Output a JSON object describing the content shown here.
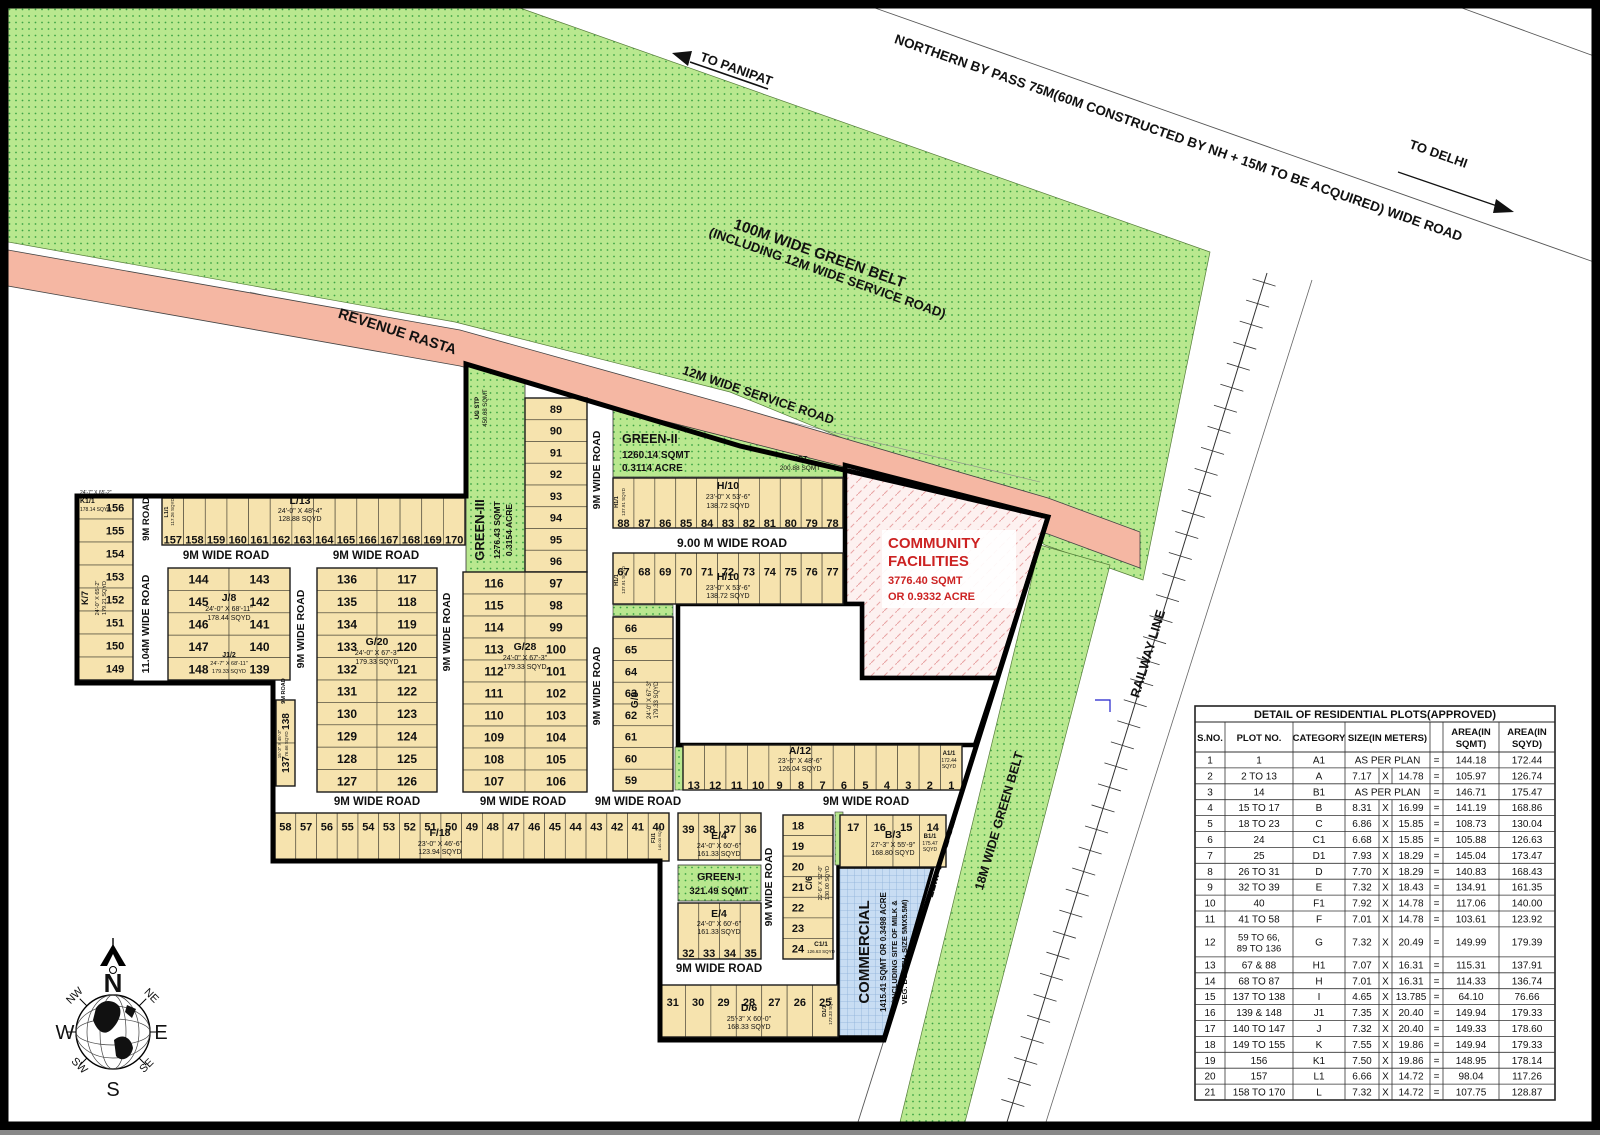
{
  "header": {
    "to_panipat": "TO PANIPAT",
    "to_delhi": "TO DELHI",
    "bypass_road": "NORTHERN BY PASS 75M(60M CONSTRUCTED BY NH + 15M TO BE ACQUIRED) WIDE ROAD",
    "green_belt_line1": "100M WIDE GREEN BELT",
    "green_belt_line2": "(INCLUDING 12M WIDE SERVICE ROAD)",
    "revenue_rasta": "REVENUE RASTA",
    "service_road_top": "12M WIDE SERVICE ROAD"
  },
  "right_side": {
    "service_road": "12M WIDE SERVICE ROAD",
    "green_belt": "18M WIDE GREEN BELT",
    "railway": "RAILWAY LINE"
  },
  "roads": {
    "nine_wide": "9M WIDE ROAD",
    "nine": "9M ROAD",
    "nine00": "9.00 M WIDE ROAD",
    "eleven": "11.04M WIDE ROAD"
  },
  "green_areas": {
    "green1": [
      "GREEN-I",
      "321.49 SQMT"
    ],
    "green2": [
      "GREEN-II",
      "1260.14 SQMT",
      "0.3114 ACRE"
    ],
    "green3": [
      "GREEN-III",
      "1276.43 SQMT",
      "0.3154 ACRE"
    ],
    "ug_stp": [
      "UG STP",
      "450.68 SQMT"
    ],
    "ugt": [
      "UGT",
      "200.88 SQMT"
    ]
  },
  "community": {
    "line1": "COMMUNITY",
    "line2": "FACILITIES",
    "area": "3776.40 SQMT",
    "acre": "OR 0.9332 ACRE"
  },
  "commercial": {
    "name": "COMMERCIAL",
    "line1": "1415.41 SQMT OR 0.3498 ACRE",
    "line2": "(INCLUDING SITE OF MILK &",
    "line3": "VEG. BOOTH- SIZE 5MX5.5M)"
  },
  "blocks": {
    "k": {
      "plots": [
        "156",
        "155",
        "154",
        "153",
        "152",
        "151",
        "150",
        "149"
      ],
      "label": {
        "name": "K/7",
        "dims": "24'-0\" X 65'-2\"",
        "area": "179.21 SQYD"
      }
    },
    "k1": {
      "name": "K1/1",
      "dims": "24'-7\" X 65'-2\"",
      "area": "178.14 SQYD"
    },
    "l": {
      "plots": [
        "157",
        "158",
        "159",
        "160",
        "161",
        "162",
        "163",
        "164",
        "165",
        "166",
        "167",
        "168",
        "169",
        "170"
      ],
      "label": {
        "name": "L/13",
        "dims": "24'-0\" X 48'-4\"",
        "area": "128.88 SQYD"
      }
    },
    "l1": {
      "name": "L1/1",
      "area": "117.26 SQYD"
    },
    "j": {
      "rows": [
        [
          "144",
          "143"
        ],
        [
          "145",
          "142"
        ],
        [
          "146",
          "141"
        ],
        [
          "147",
          "140"
        ],
        [
          "148",
          "139"
        ]
      ],
      "label": {
        "name": "J/8",
        "dims": "24'-0\" X 68'-11\"",
        "area": "178.44 SQYD"
      },
      "label2": {
        "name": "J1/2",
        "dims": "24'-7\" X 68'-11\"",
        "area": "179.33 SQYD"
      }
    },
    "i": {
      "plots": [
        "138",
        "137"
      ],
      "label": {
        "dims": "15'-3\" X 45'-3\"",
        "area": "76.66 SQYD"
      }
    },
    "g20": {
      "rows": [
        [
          "136",
          "117"
        ],
        [
          "135",
          "118"
        ],
        [
          "134",
          "119"
        ],
        [
          "133",
          "120"
        ],
        [
          "132",
          "121"
        ],
        [
          "131",
          "122"
        ],
        [
          "130",
          "123"
        ],
        [
          "129",
          "124"
        ],
        [
          "128",
          "125"
        ],
        [
          "127",
          "126"
        ]
      ],
      "label": {
        "name": "G/20",
        "dims": "24'-0\" X 67'-3\"",
        "area": "179.33 SQYD"
      }
    },
    "g_top": {
      "plots": [
        "89",
        "90",
        "91",
        "92",
        "93",
        "94",
        "95",
        "96"
      ]
    },
    "g28": {
      "rows": [
        [
          "116",
          "97"
        ],
        [
          "115",
          "98"
        ],
        [
          "114",
          "99"
        ],
        [
          "113",
          "100"
        ],
        [
          "112",
          "101"
        ],
        [
          "111",
          "102"
        ],
        [
          "110",
          "103"
        ],
        [
          "109",
          "104"
        ],
        [
          "108",
          "105"
        ],
        [
          "107",
          "106"
        ]
      ],
      "label": {
        "name": "G/28",
        "dims": "24'-0\" X 67'-3\"",
        "area": "179.33 SQYD"
      }
    },
    "h_top": {
      "plots": [
        "88",
        "87",
        "86",
        "85",
        "84",
        "83",
        "82",
        "81",
        "80",
        "79",
        "78"
      ],
      "label": {
        "name": "H/10",
        "dims": "23'-0\" X 53'-6\"",
        "area": "138.72 SQYD"
      }
    },
    "h_bot": {
      "plots": [
        "67",
        "68",
        "69",
        "70",
        "71",
        "72",
        "73",
        "74",
        "75",
        "76",
        "77"
      ],
      "label": {
        "name": "H/10",
        "dims": "23'-0\" X 53'-6\"",
        "area": "138.72 SQYD"
      }
    },
    "h1": {
      "name": "H1/1",
      "area": "137.91 SQYD"
    },
    "g8": {
      "plots": [
        "66",
        "65",
        "64",
        "63",
        "62",
        "61",
        "60",
        "59"
      ],
      "label": {
        "name": "G/8",
        "dims": "24'-0\" X 67'-3\"",
        "area": "179.33 SQYD"
      }
    },
    "a": {
      "plots": [
        "13",
        "12",
        "11",
        "10",
        "9",
        "8",
        "7",
        "6",
        "5",
        "4",
        "3",
        "2",
        "1"
      ],
      "label": {
        "name": "A/12",
        "dims": "23'-6\" X 48'-6\"",
        "area": "126.04 SQYD"
      }
    },
    "a1": {
      "name": "A1/1",
      "area1": "172.44",
      "area2": "SQYD"
    },
    "f": {
      "plots": [
        "58",
        "57",
        "56",
        "55",
        "54",
        "53",
        "52",
        "51",
        "50",
        "49",
        "48",
        "47",
        "46",
        "45",
        "44",
        "43",
        "42",
        "41",
        "40"
      ],
      "label": {
        "name": "F/18",
        "dims": "23'-0\" X 46'-6\"",
        "area": "123.94 SQYD"
      }
    },
    "f1": {
      "name": "F1/1",
      "area": "140.00 SQYD"
    },
    "e_top": {
      "plots": [
        "39",
        "38",
        "37",
        "36"
      ],
      "label": {
        "name": "E/4",
        "dims": "24'-0\" X 60'-6\"",
        "area": "161.33 SQYD"
      }
    },
    "e_bot": {
      "plots": [
        "32",
        "33",
        "34",
        "35"
      ],
      "label": {
        "name": "E/4",
        "dims": "24'-0\" X 60'-6\"",
        "area": "161.33 SQYD"
      }
    },
    "d": {
      "plots": [
        "31",
        "30",
        "29",
        "28",
        "27",
        "26",
        "25"
      ],
      "label": {
        "name": "D/6",
        "dims": "25'-3\" X 60'-0\"",
        "area": "168.33 SQYD"
      }
    },
    "d1": {
      "name": "D1/1",
      "area": "173.33 SQYD"
    },
    "c": {
      "plots": [
        "18",
        "19",
        "20",
        "21",
        "22",
        "23",
        "24"
      ],
      "label": {
        "name": "C/6",
        "dims": "22'-6\" X 52'-0\"",
        "area": "130.00 SQYD"
      }
    },
    "c1": {
      "name": "C1/1",
      "area": "126.63 SQYD"
    },
    "b": {
      "plots": [
        "17",
        "16",
        "15",
        "14"
      ],
      "label": {
        "name": "B/3",
        "dims": "27'-3\" X 55'-9\"",
        "area": "168.80 SQYD"
      }
    },
    "b1": {
      "name": "B1/1",
      "area1": "175.47",
      "area2": "SQYD"
    }
  },
  "compass": {
    "n": "N",
    "ne": "NE",
    "e": "E",
    "se": "SE",
    "s": "S",
    "sw": "SW",
    "w": "W",
    "nw": "NW"
  },
  "table": {
    "title": "DETAIL OF RESIDENTIAL PLOTS(APPROVED)",
    "headers": {
      "sno": "S.NO.",
      "plot": "PLOT NO.",
      "cat": "CATEGORY",
      "size": "SIZE(IN METERS)",
      "sqmt1": "AREA(IN",
      "sqmt2": "SQMT)",
      "sqyd1": "AREA(IN",
      "sqyd2": "SQYD)"
    },
    "x_sep": "X",
    "eq": "=",
    "rows": [
      [
        "1",
        "1",
        "A1",
        [
          "AS PER PLAN"
        ],
        "144.18",
        "172.44"
      ],
      [
        "2",
        "2 TO 13",
        "A",
        [
          "7.17",
          "14.78"
        ],
        "105.97",
        "126.74"
      ],
      [
        "3",
        "14",
        "B1",
        [
          "AS PER PLAN"
        ],
        "146.71",
        "175.47"
      ],
      [
        "4",
        "15 TO 17",
        "B",
        [
          "8.31",
          "16.99"
        ],
        "141.19",
        "168.86"
      ],
      [
        "5",
        "18 TO 23",
        "C",
        [
          "6.86",
          "15.85"
        ],
        "108.73",
        "130.04"
      ],
      [
        "6",
        "24",
        "C1",
        [
          "6.68",
          "15.85"
        ],
        "105.88",
        "126.63"
      ],
      [
        "7",
        "25",
        "D1",
        [
          "7.93",
          "18.29"
        ],
        "145.04",
        "173.47"
      ],
      [
        "8",
        "26 TO 31",
        "D",
        [
          "7.70",
          "18.29"
        ],
        "140.83",
        "168.43"
      ],
      [
        "9",
        "32 TO 39",
        "E",
        [
          "7.32",
          "18.43"
        ],
        "134.91",
        "161.35"
      ],
      [
        "10",
        "40",
        "F1",
        [
          "7.92",
          "14.78"
        ],
        "117.06",
        "140.00"
      ],
      [
        "11",
        "41 TO 58",
        "F",
        [
          "7.01",
          "14.78"
        ],
        "103.61",
        "123.92"
      ],
      [
        "12",
        "59 TO 66,|89 TO 136",
        "G",
        [
          "7.32",
          "20.49"
        ],
        "149.99",
        "179.39"
      ],
      [
        "13",
        "67 & 88",
        "H1",
        [
          "7.07",
          "16.31"
        ],
        "115.31",
        "137.91"
      ],
      [
        "14",
        "68 TO 87",
        "H",
        [
          "7.01",
          "16.31"
        ],
        "114.33",
        "136.74"
      ],
      [
        "15",
        "137 TO 138",
        "I",
        [
          "4.65",
          "13.785"
        ],
        "64.10",
        "76.66"
      ],
      [
        "16",
        "139 & 148",
        "J1",
        [
          "7.35",
          "20.40"
        ],
        "149.94",
        "179.33"
      ],
      [
        "17",
        "140 TO 147",
        "J",
        [
          "7.32",
          "20.40"
        ],
        "149.33",
        "178.60"
      ],
      [
        "18",
        "149 TO 155",
        "K",
        [
          "7.55",
          "19.86"
        ],
        "149.94",
        "179.33"
      ],
      [
        "19",
        "156",
        "K1",
        [
          "7.50",
          "19.86"
        ],
        "148.95",
        "178.14"
      ],
      [
        "20",
        "157",
        "L1",
        [
          "6.66",
          "14.72"
        ],
        "98.04",
        "117.26"
      ],
      [
        "21",
        "158 TO 170",
        "L",
        [
          "7.32",
          "14.72"
        ],
        "107.75",
        "128.87"
      ]
    ]
  },
  "colors": {
    "plot_fill": "#f6e3ae",
    "green_fill": "#b9e88f",
    "green_dot": "#3da344",
    "pink_road": "#f5b7a3",
    "community_red": "#cc2222",
    "commercial_blue": "#c8ddf3"
  }
}
